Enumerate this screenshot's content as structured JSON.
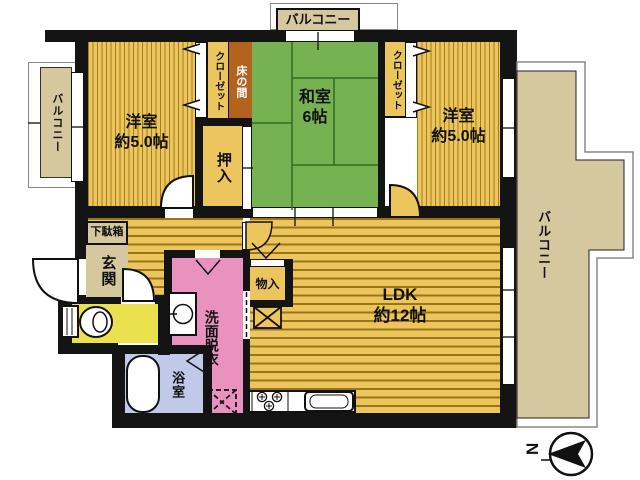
{
  "plan": {
    "title": "apartment-floor-plan",
    "rooms": {
      "yoshitsu_left": {
        "name": "洋室",
        "size": "約5.0帖"
      },
      "washitsu": {
        "name": "和室",
        "size": "6帖"
      },
      "yoshitsu_right": {
        "name": "洋室",
        "size": "約5.0帖"
      },
      "ldk": {
        "name": "LDK",
        "size": "約12帖"
      },
      "closet_left": {
        "name": "クローゼット"
      },
      "closet_right": {
        "name": "クローゼット"
      },
      "tokonoma": {
        "name": "床の間"
      },
      "oshiire": {
        "name": "押入"
      },
      "getabako": {
        "name": "下駄箱"
      },
      "genkan": {
        "name": "玄関"
      },
      "senmen": {
        "name": "洗面脱衣"
      },
      "bathroom": {
        "name": "浴室"
      },
      "monoire": {
        "name": "物入"
      }
    },
    "balconies": {
      "top": {
        "name": "バルコニー"
      },
      "left": {
        "name": "バルコニー"
      },
      "right": {
        "name": "バルコニー"
      }
    },
    "compass": {
      "label": "N"
    },
    "colors": {
      "wall": "#141414",
      "wood_yellow": "#ecc65c",
      "tatami_green": "#76b251",
      "balcony_tan": "#d5c79e",
      "washroom_pink": "#e992c0",
      "bath_blue": "#c0cae8",
      "toilet_yellow": "#ebe14e",
      "tokonoma_brown": "#b4631e"
    }
  }
}
